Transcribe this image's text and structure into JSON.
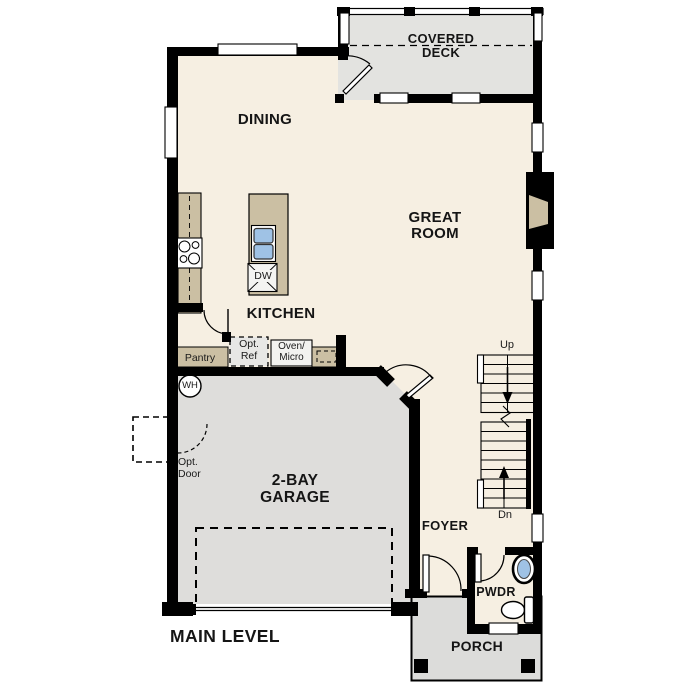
{
  "plan": {
    "title": "MAIN LEVEL"
  },
  "rooms": {
    "covered_deck": {
      "line1": "COVERED",
      "line2": "DECK"
    },
    "dining": {
      "label": "DINING"
    },
    "great_room": {
      "line1": "GREAT",
      "line2": "ROOM"
    },
    "kitchen": {
      "label": "KITCHEN"
    },
    "garage": {
      "line1": "2-BAY",
      "line2": "GARAGE"
    },
    "foyer": {
      "label": "FOYER"
    },
    "powder": {
      "label": "PWDR"
    },
    "porch": {
      "label": "PORCH"
    }
  },
  "stairs": {
    "up": "Up",
    "down": "Dn"
  },
  "kitchen_features": {
    "pantry": "Pantry",
    "opt_ref_line1": "Opt.",
    "opt_ref_line2": "Ref",
    "oven_micro_line1": "Oven/",
    "oven_micro_line2": "Micro",
    "dishwasher": "DW"
  },
  "garage_features": {
    "water_heater": "WH",
    "opt_door_line1": "Opt.",
    "opt_door_line2": "Door"
  },
  "colors": {
    "wall": "#000000",
    "floor": "#f6efe2",
    "deck": "#e3e3e0",
    "garage": "#dedddb",
    "porch": "#dcdcda",
    "cabinet": "#cbbfa3",
    "appliance": "#e7e7e5",
    "fixture_blue": "#9fc2e5"
  }
}
